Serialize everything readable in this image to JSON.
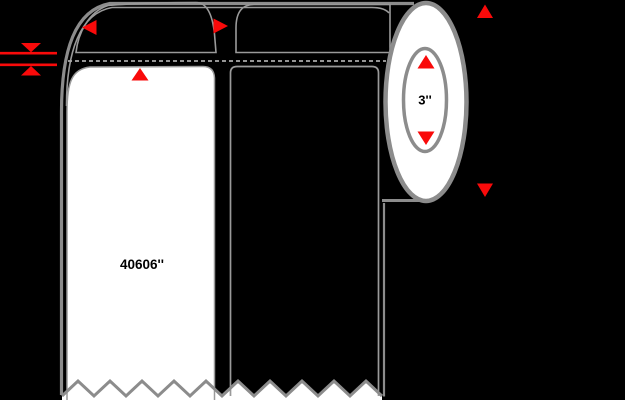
{
  "diagram": {
    "name": "label-roll-dimension-diagram",
    "core_diameter_label": "3''",
    "label_part_number": "40606''",
    "colors": {
      "background": "#000000",
      "outline_thick": "#8c8c8c",
      "outline_thin": "#9a9a9a",
      "dashed_line": "#aaaaaa",
      "dimension_arrow": "#f90a0a",
      "label_fill": "#ffffff",
      "text": "#000000"
    },
    "icons": [
      "label-width-left-arrow-icon",
      "label-width-right-arrow-icon",
      "gap-top-arrow-icon",
      "gap-bottom-arrow-icon",
      "core-diameter-up-arrow-icon",
      "core-diameter-down-arrow-icon",
      "roll-od-up-arrow-icon",
      "roll-od-down-arrow-icon"
    ]
  }
}
